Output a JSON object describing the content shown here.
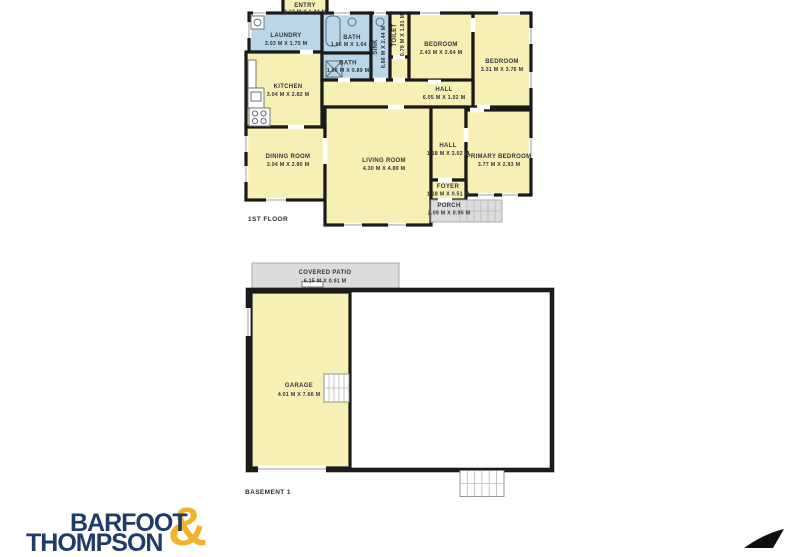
{
  "colors": {
    "wall": "#1a1a1a",
    "room_yellow": "#f7f0b5",
    "wet_blue": "#bad7e9",
    "patio_gray": "#dcdcdc",
    "logo_navy": "#1d3c6b",
    "logo_gold": "#f2b32a"
  },
  "floor1": {
    "label": "1ST FLOOR",
    "rooms": {
      "entry": {
        "name": "ENTRY",
        "dims": "2.12 M X 1.44 M"
      },
      "laundry": {
        "name": "LAUNDRY",
        "dims": "3.03 M X 1.75 M"
      },
      "bath_top": {
        "name": "BATH",
        "dims": "1.66 M X 1.64 M"
      },
      "bath_lower": {
        "name": "BATH",
        "dims": "1.66 M X 0.89 M"
      },
      "sink": {
        "name": "SINK",
        "dims": "0.86 M X 2.44 M"
      },
      "toilet": {
        "name": "TOILET",
        "dims": "0.79 M X 1.81 M"
      },
      "bedroom1": {
        "name": "BEDROOM",
        "dims": "2.43 M X 2.64 M"
      },
      "bedroom2": {
        "name": "BEDROOM",
        "dims": "3.31 M X 3.76 M"
      },
      "kitchen": {
        "name": "KITCHEN",
        "dims": "3.04 M X 2.82 M"
      },
      "hall": {
        "name": "HALL",
        "dims": "6.05 M X 1.02 M"
      },
      "dining": {
        "name": "DINING ROOM",
        "dims": "3.04 M X 2.80 M"
      },
      "living": {
        "name": "LIVING ROOM",
        "dims": "4.30 M X 4.89 M"
      },
      "hall2": {
        "name": "HALL",
        "dims": "1.18 M X 3.02 M"
      },
      "primary": {
        "name": "PRIMARY BEDROOM",
        "dims": "3.77 M X 2.93 M"
      },
      "foyer": {
        "name": "FOYER",
        "dims": "1.18 M X 0.51 M"
      },
      "porch": {
        "name": "PORCH",
        "dims": "2.09 M X 0.95 M"
      }
    }
  },
  "basement": {
    "label": "BASEMENT 1",
    "rooms": {
      "covered_patio": {
        "name": "COVERED PATIO",
        "dims": "6.15 M X 0.91 M"
      },
      "garage": {
        "name": "GARAGE",
        "dims": "4.01 M X 7.66 M"
      }
    }
  },
  "branding": {
    "line1": "BARFOOT",
    "line2": "THOMPSON",
    "ampersand": "&"
  }
}
